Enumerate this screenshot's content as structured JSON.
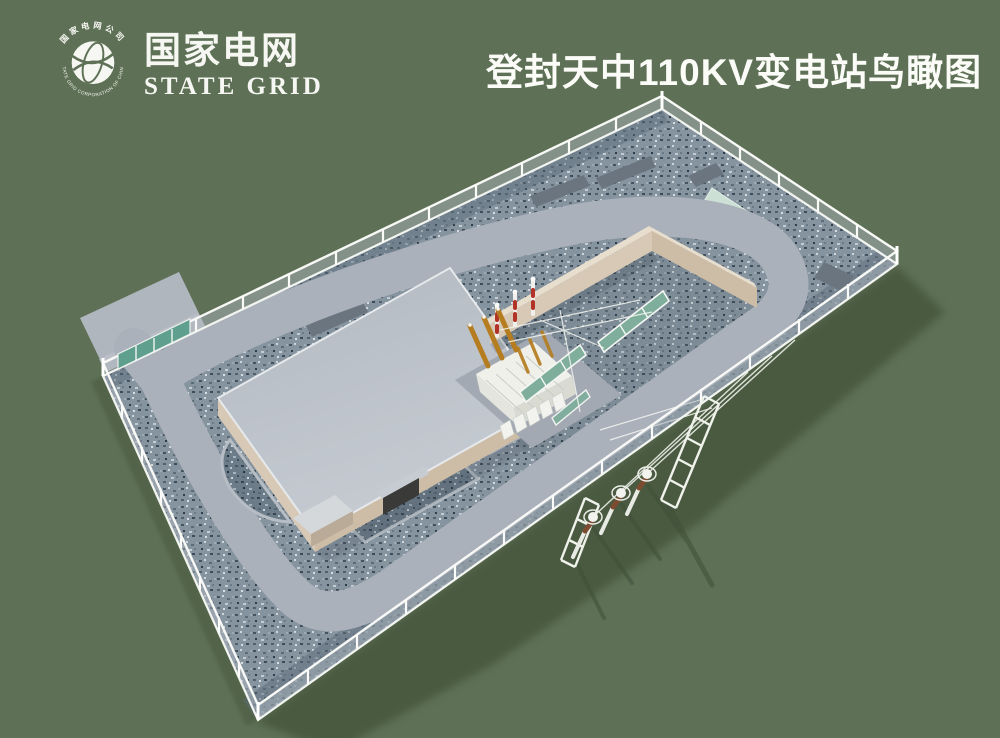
{
  "page": {
    "width": 1000,
    "height": 738,
    "background": "#5e7156"
  },
  "header": {
    "logo": {
      "name_cn": "国家电网",
      "name_en": "STATE GRID",
      "rim_text_cn": "国家电网公司",
      "rim_text_en": "STATE GRID CORPORATION OF CHINA"
    },
    "title": "登封天中110KV变电站鸟瞰图"
  },
  "colors": {
    "bg": "#5e7156",
    "shadow": "#47573e",
    "title": "#fbfcf7",
    "logo": "#f6f7f2",
    "gravel": "#8694a0",
    "road": "#aab1bb",
    "roof": "#bcc2ca",
    "wallLight": "#d7c9b6",
    "wallDark": "#cdbda7",
    "fence": "#f2f4f0",
    "mesh": "#a9b2ba",
    "mint": "#cde0d5",
    "teal": "#5f9f8e",
    "panel": "#7fae9c",
    "amber": "#b57d20",
    "rodRed": "#b23327",
    "padDark": "#6b7580",
    "cream": "#eff0ea"
  }
}
